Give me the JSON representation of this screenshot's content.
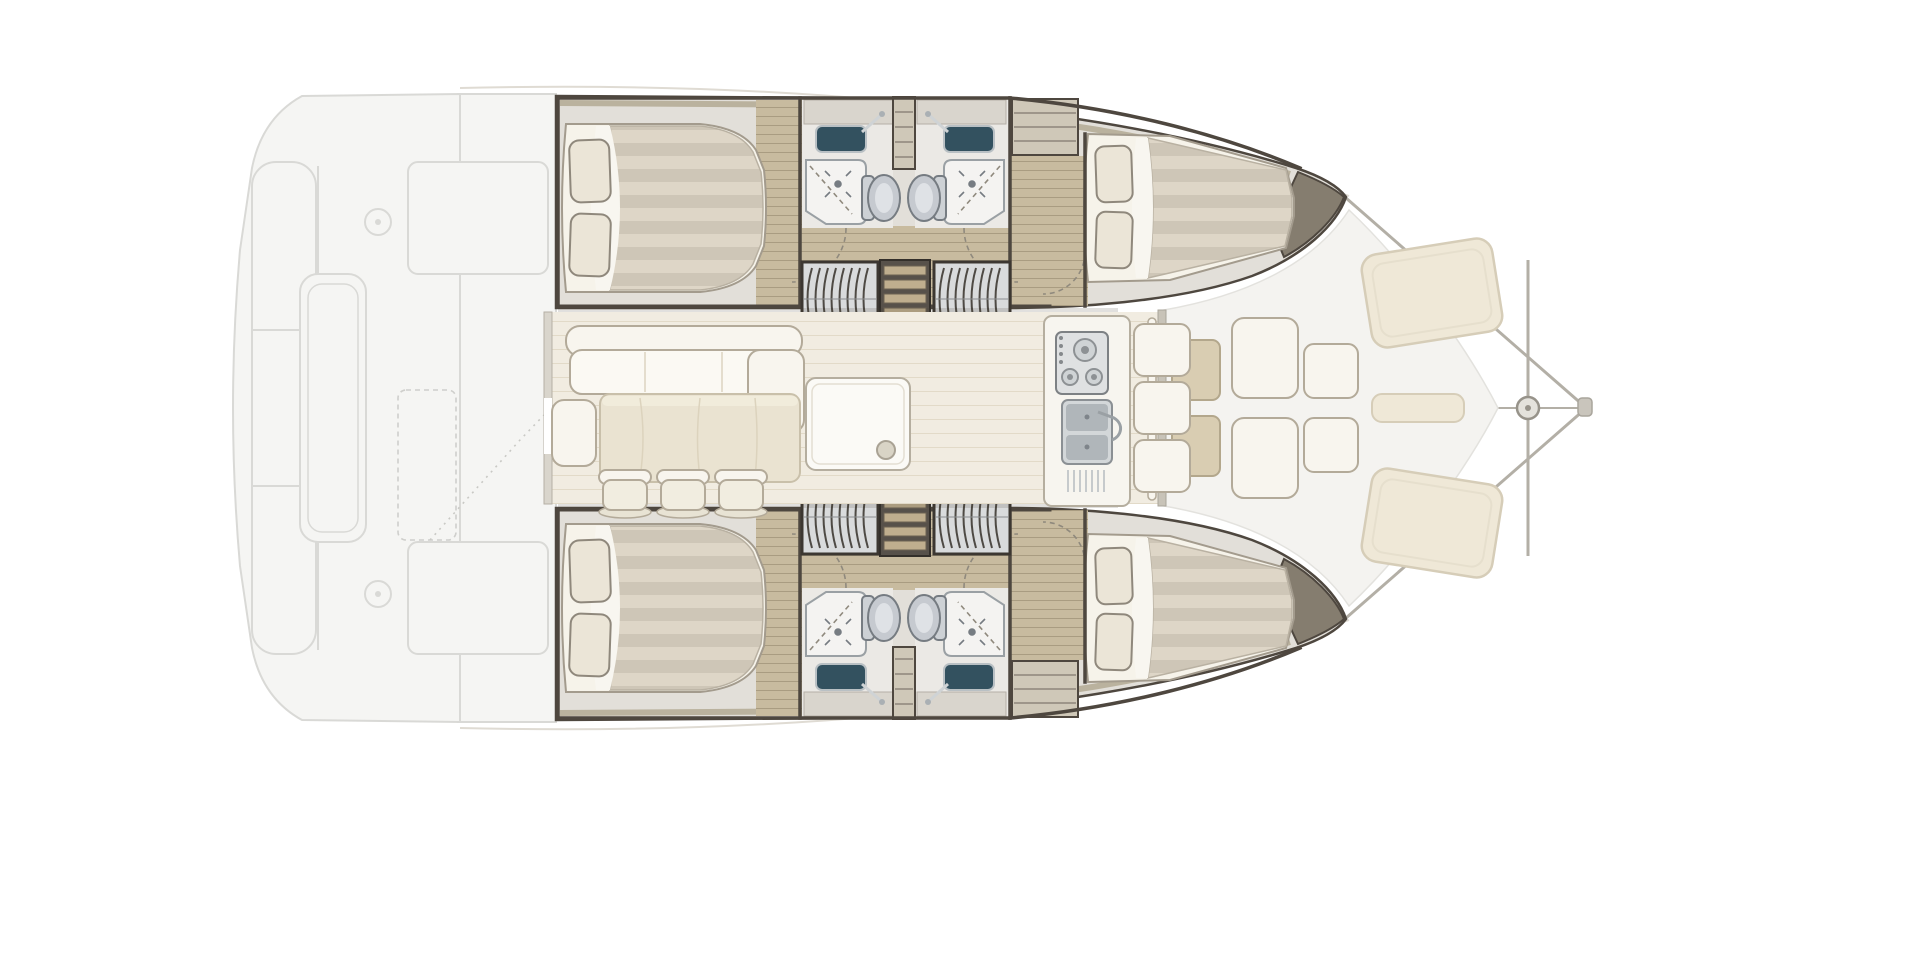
{
  "meta": {
    "title": "Catamaran interior floor plan, top-down brochure illustration, bow to the right",
    "text_visible": false
  },
  "colors": {
    "paper": "#ffffff",
    "faded": "#d9d9d6",
    "fadedfill": "#f5f5f3",
    "hullbase": "#d8d3c9",
    "wall": "#4e473f",
    "rim": "#b6ad97",
    "wood": "#c8bb9f",
    "woodline": "#a99c81",
    "cabinfloor": "#e2dfd9",
    "bathfloor": "#ebe9e5",
    "mattress": "#f6f3ea",
    "duveta": "#ded6c7",
    "duvetb": "#cec6b7",
    "pillow": "#ebe5d7",
    "pillowedge": "#8f887c",
    "basin": "#33515f",
    "metal": "#cfd3d5",
    "metaldark": "#aab0b4",
    "fixline": "#767c82",
    "sofa": "#f8f5ee",
    "sofaline": "#b3aa99",
    "tablewood": "#eae3d1",
    "tableline": "#c9c0aa",
    "deck": "#f1ece1",
    "deckline": "#e2dac8",
    "pad": "#efe8d7",
    "padline": "#d6cdb8",
    "stairframe": "#3c3731",
    "stairfill": "#d9dbdc",
    "slat": "#4e4a44",
    "stepwood": "#bfae8e",
    "shadow": "rgba(70,60,50,0.16)",
    "rigging": "#b3afa6",
    "arc": "#8f897d",
    "bowlocker": "#857d6f"
  },
  "inventory": {
    "hulls": [
      {
        "id": "top-hull",
        "rooms": [
          {
            "name": "aft-double-cabin",
            "items": [
              "double bed",
              "2 pillows",
              "striped duvet",
              "wood plank floor"
            ]
          },
          {
            "name": "aft-bathroom",
            "items": [
              "vanity sink with faucet",
              "shower with door arc",
              "toilet"
            ]
          },
          {
            "name": "forward-bathroom",
            "items": [
              "vanity sink with faucet",
              "shower with door arc",
              "toilet"
            ]
          },
          {
            "name": "forward-double-cabin",
            "items": [
              "double bed",
              "2 pillows",
              "striped duvet"
            ]
          }
        ],
        "stairs": "two curved companionway step housings flanking a ladder down from the salon",
        "storage": [
          "shelf divider between bathrooms",
          "wardrobe shelves forward of bathrooms",
          "bow locker"
        ]
      },
      {
        "id": "bottom-hull",
        "mirror_of": "top-hull"
      }
    ],
    "salon": {
      "items": [
        "L-shaped sofa",
        "rectangular dining table",
        "3 stools",
        "side seat",
        "storage cabinet with round handle",
        "galley stove with 3 burners and knobs",
        "double sink with faucet and dish rack",
        "forward bench with 3 cushions"
      ]
    },
    "aft_cockpit": {
      "style": "ghosted light gray",
      "items": [
        "curved transom outline",
        "stern bench",
        "cockpit table",
        "2 deck hatches",
        "2 winch circles",
        "dashed locker outline",
        "dotted walk path"
      ]
    },
    "foredeck": {
      "items": [
        "forward cockpit floor between bows",
        "2 low wooden tables",
        "4 bench cushions",
        "2 large angled sun pads",
        "center pad strip",
        "bow crossbeam",
        "forestay lines",
        "bow roller circle"
      ]
    }
  }
}
